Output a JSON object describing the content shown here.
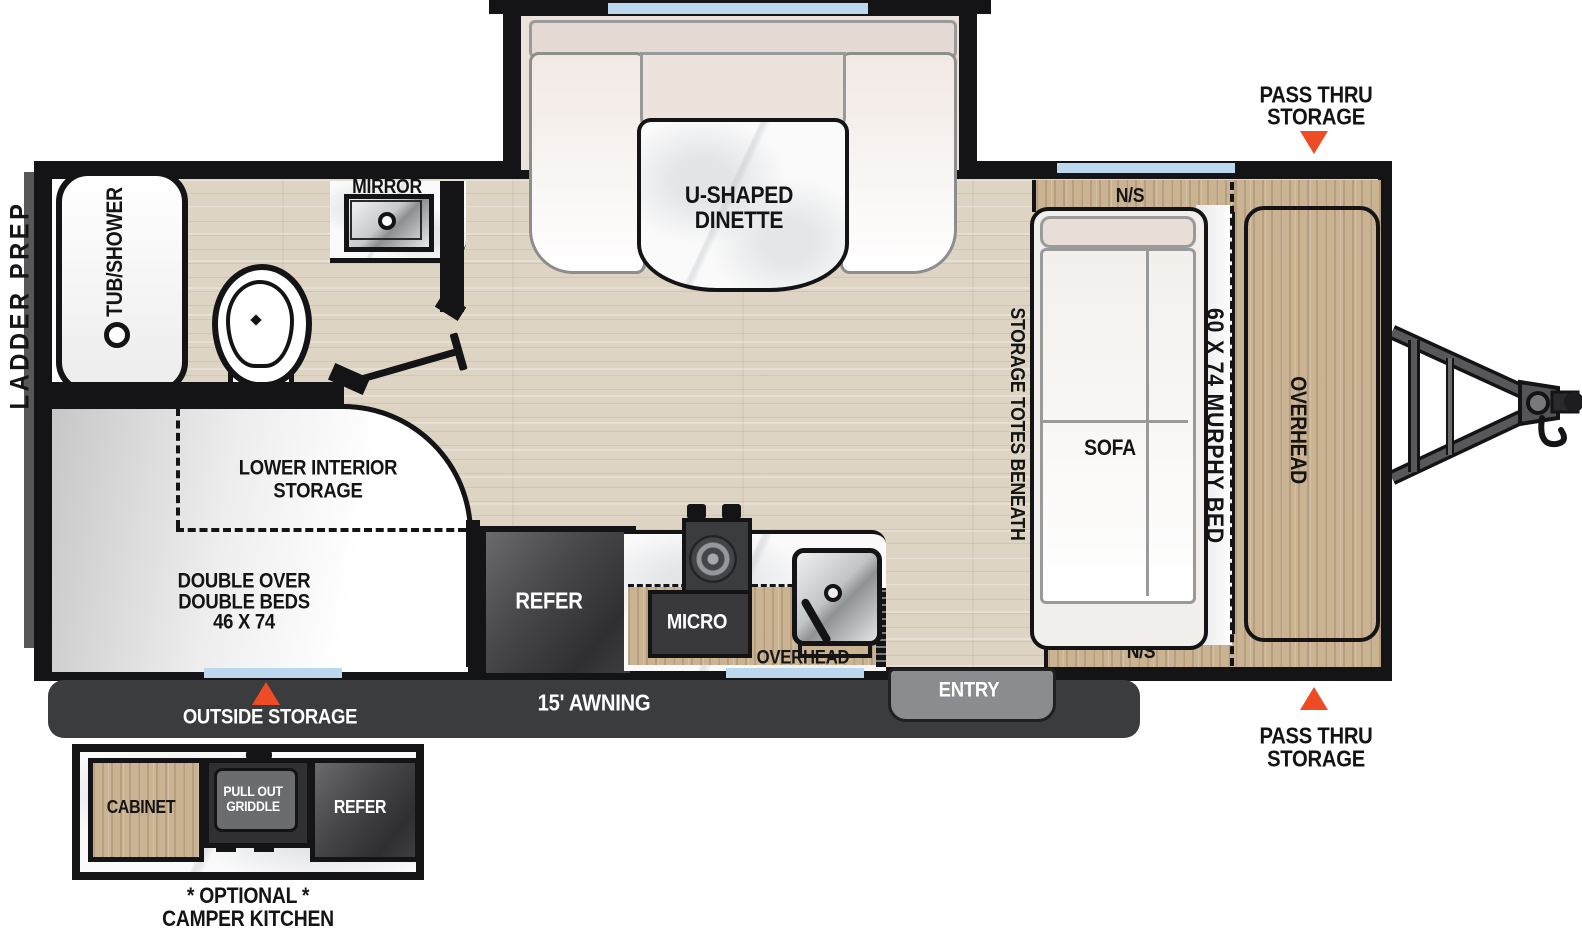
{
  "labels": {
    "ladder_prep": "LADDER PREP",
    "tub_shower": "TUB/SHOWER",
    "mirror": "MIRROR",
    "dinette_line1": "U-SHAPED",
    "dinette_line2": "DINETTE",
    "pass_thru_line1": "PASS THRU",
    "pass_thru_line2": "STORAGE",
    "night_stand": "N/S",
    "murphy_bed": "60 X 74 MURPHY BED",
    "overhead": "OVERHEAD",
    "storage_totes": "STORAGE TOTES BENEATH",
    "sofa": "SOFA",
    "lower_storage_line1": "LOWER INTERIOR",
    "lower_storage_line2": "STORAGE",
    "beds_line1": "DOUBLE OVER",
    "beds_line2": "DOUBLE BEDS",
    "beds_line3": "46 X 74",
    "refer": "REFER",
    "micro": "MICRO",
    "overhead_kitchen": "OVERHEAD",
    "entry": "ENTRY",
    "awning": "15' AWNING",
    "outside_storage": "OUTSIDE STORAGE",
    "cabinet": "CABINET",
    "griddle_line1": "PULL OUT",
    "griddle_line2": "GRIDDLE",
    "refer_optional": "REFER",
    "caption_line1": "* OPTIONAL *",
    "caption_line2": "CAMPER KITCHEN"
  },
  "dimensions": {
    "murphy_bed_size": "60 X 74",
    "double_beds_size": "46 X 74",
    "awning_length": "15'"
  },
  "colors": {
    "wall": "#141416",
    "accent_arrow": "#ef4b24",
    "wood": "#c9b392",
    "floor": "#ddd4c3",
    "window": "#bcd8ee",
    "awning_bar": "#3b3c3e",
    "appliance_dark": "#48484a"
  }
}
